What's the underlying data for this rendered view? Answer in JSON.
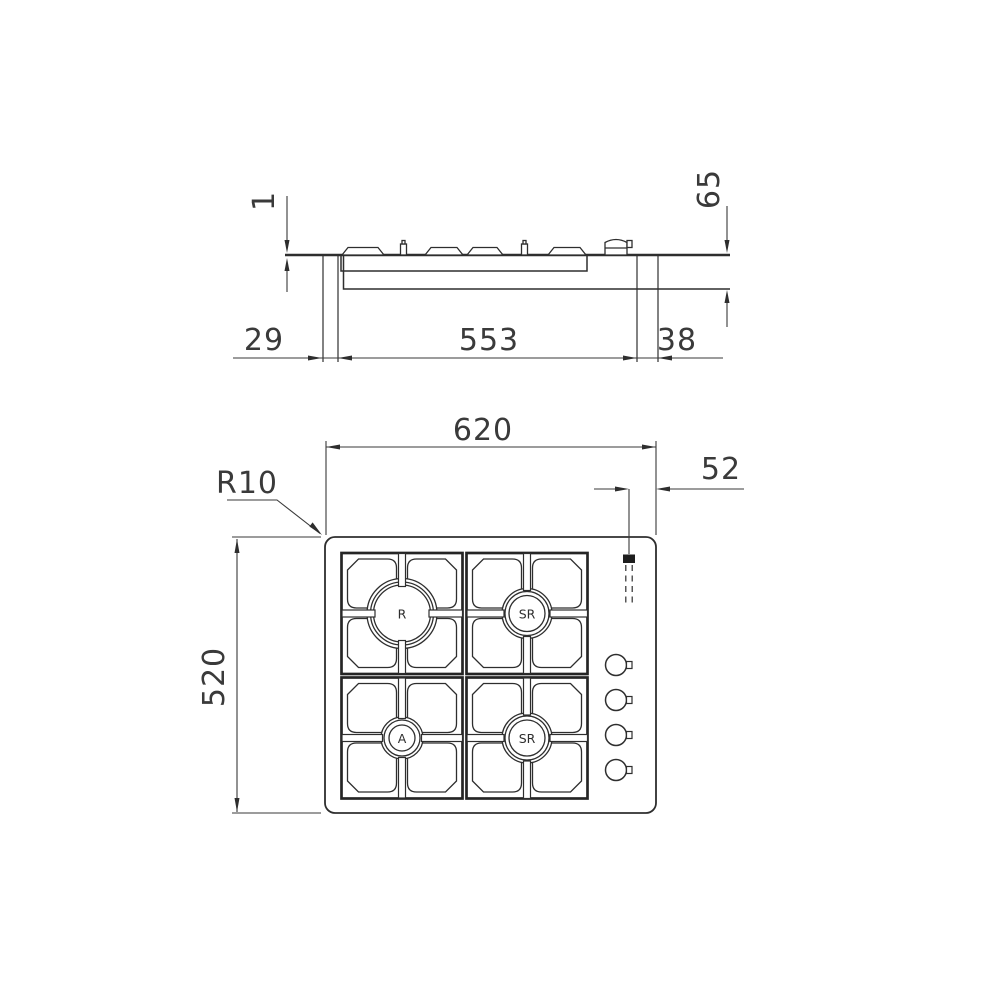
{
  "drawing": {
    "description": "Built-in 4-burner gas hob installation drawing: side section view and plan view",
    "line_color": "#2e2e2e",
    "background": "#ffffff"
  },
  "side_view": {
    "rim_height": "1",
    "depth_below_worktop": "65",
    "left_edge_to_cutout": "29",
    "cutout_width": "553",
    "cutout_to_right_edge": "38"
  },
  "plan_view": {
    "overall_width": "620",
    "overall_depth": "520",
    "corner_radius_label": "R10",
    "ignition_to_edge": "52",
    "burners": [
      {
        "id": "rapid-rear-left",
        "label": "R"
      },
      {
        "id": "semi-rapid-rear-right",
        "label": "SR"
      },
      {
        "id": "auxiliary-front-left",
        "label": "A"
      },
      {
        "id": "semi-rapid-front-right",
        "label": "SR"
      }
    ]
  }
}
